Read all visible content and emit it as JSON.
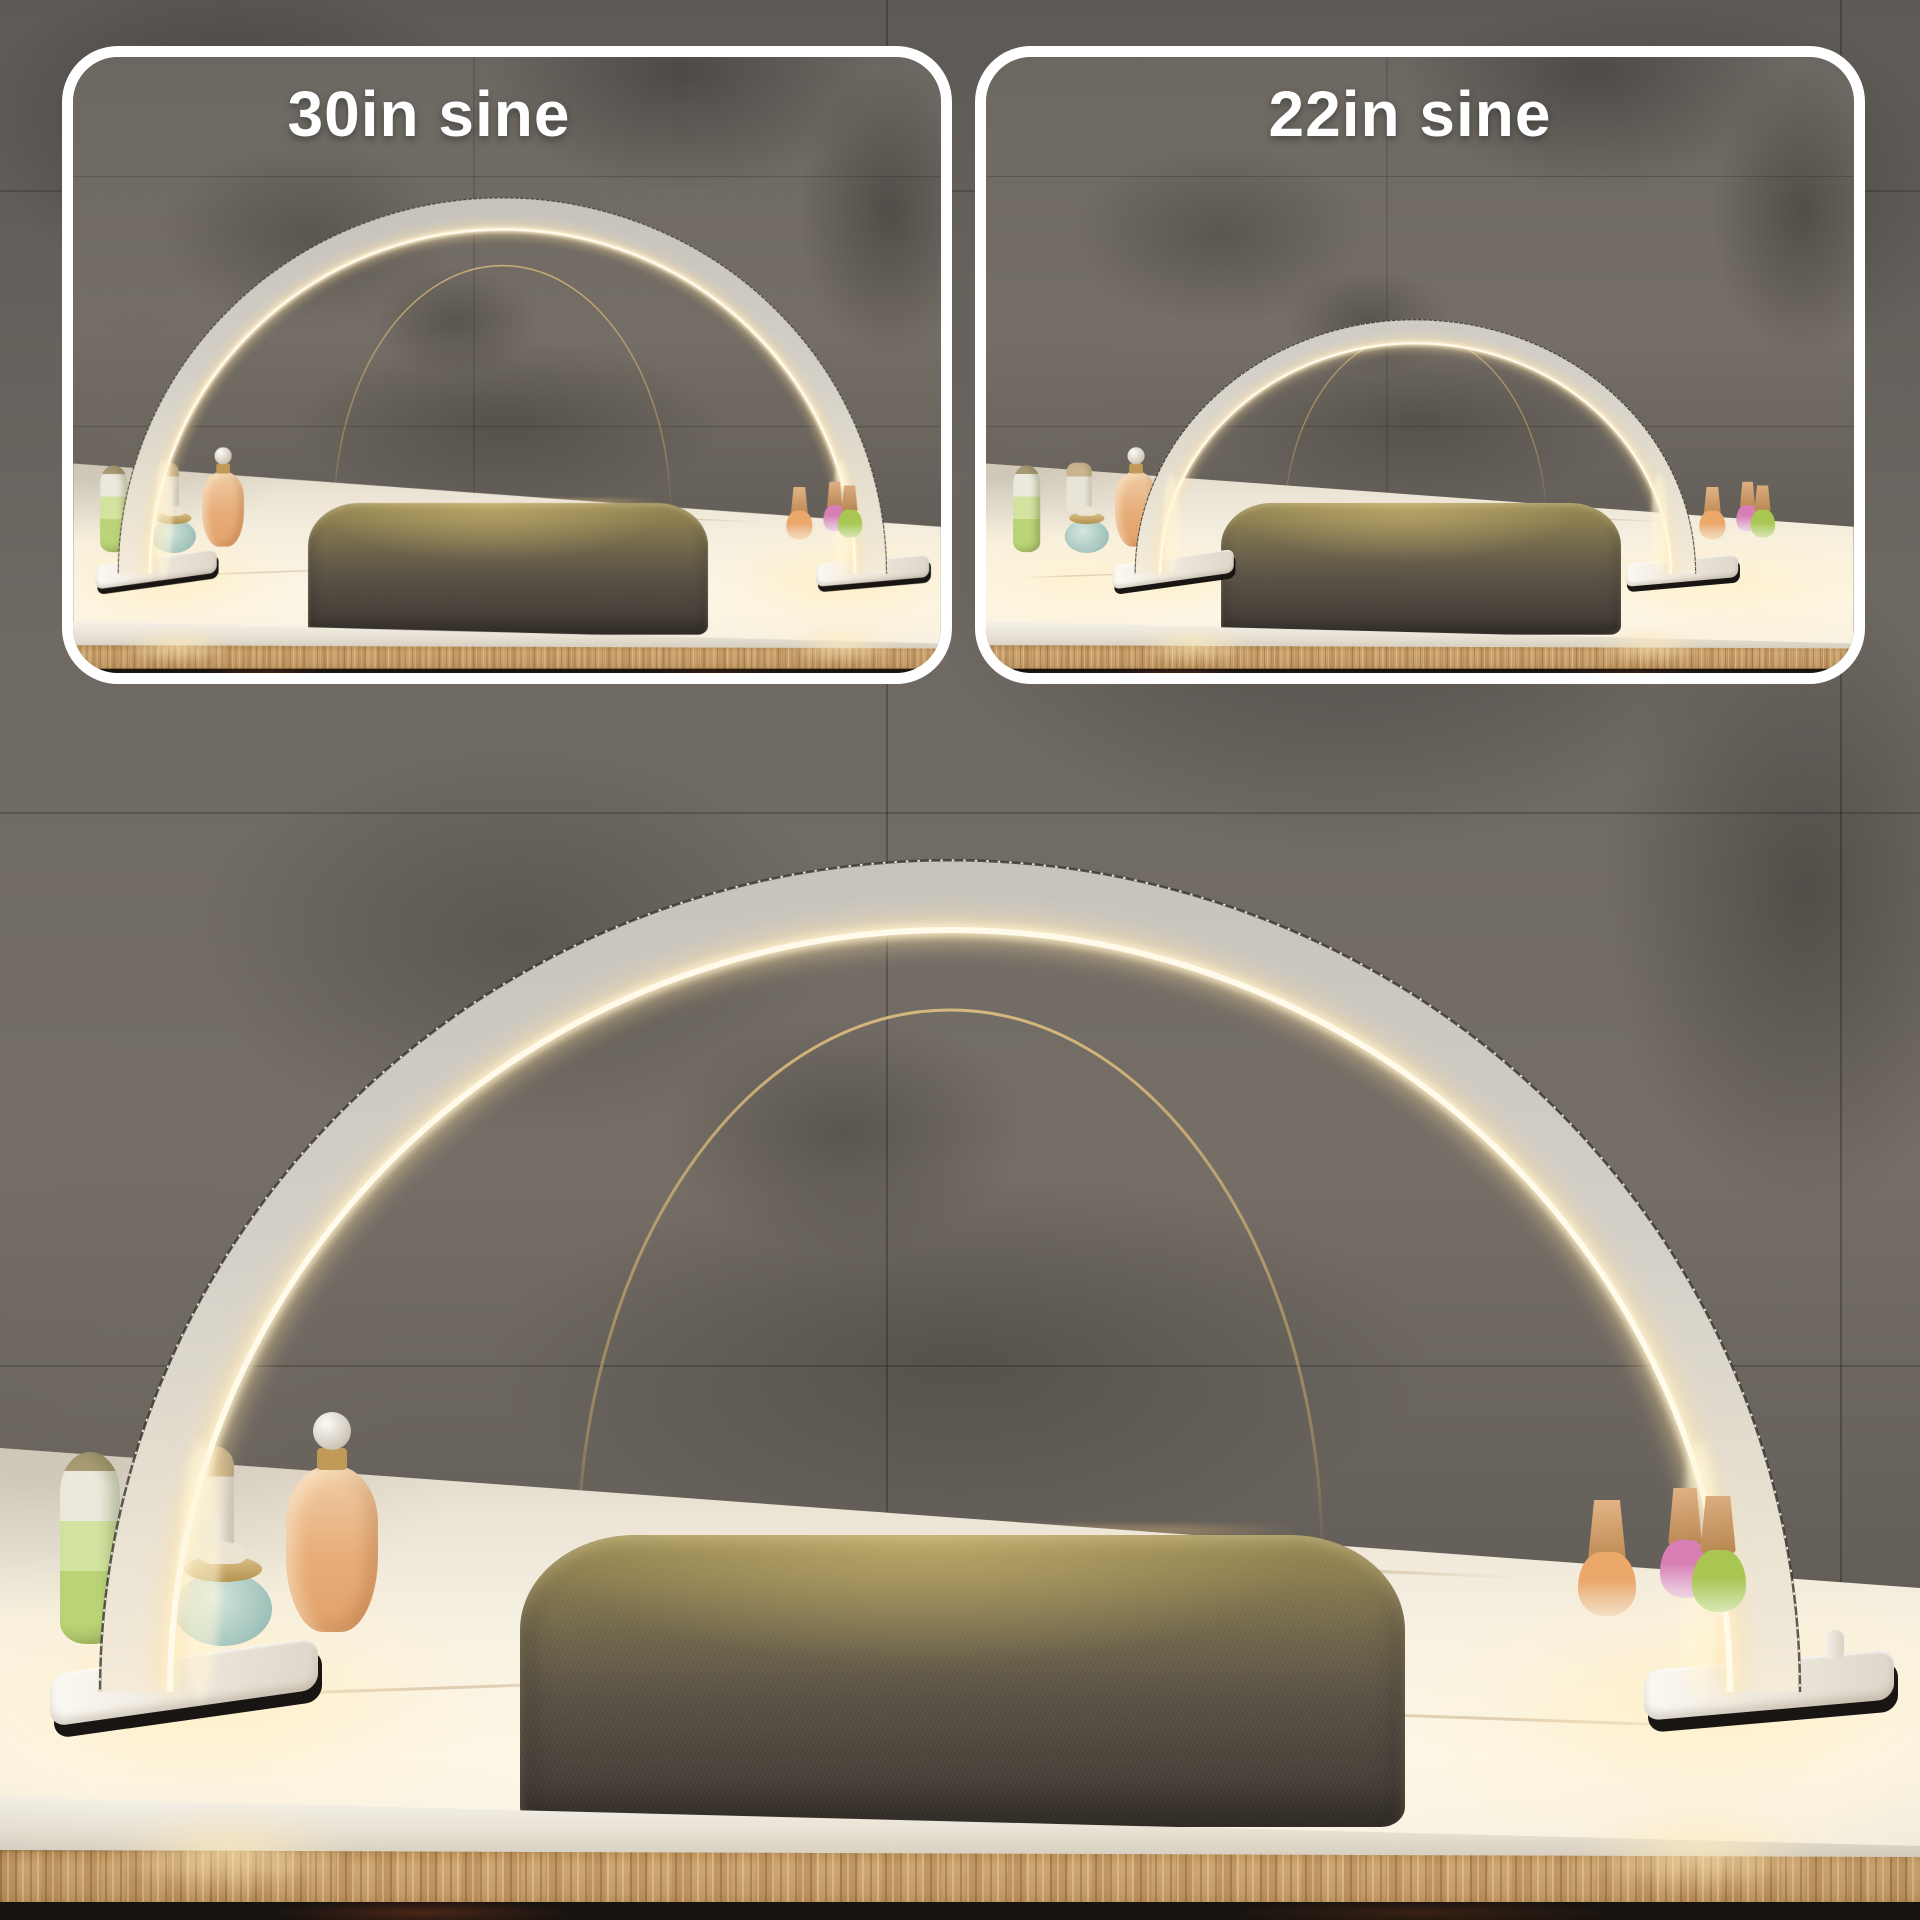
{
  "panels": [
    {
      "id": "30in",
      "label": "30in sine"
    },
    {
      "id": "22in",
      "label": "22in sine"
    }
  ],
  "colors": {
    "panel_border": "#ffffff",
    "label_text": "#ffffff",
    "wall_marble": "#6b6661",
    "countertop": "#f7f1e3",
    "wood_edge": "#c59d69",
    "lamp_body": "#cdc9c1",
    "lamp_led_glow": "#fff6dd",
    "reflection_gold": "#d0ad72",
    "cushion_lit": "#96874f",
    "cushion_dark": "#4a443b",
    "polish_orange": "#eca86b",
    "polish_pink": "#d77fb4",
    "polish_green": "#a9c653",
    "cap_rose_gold": "#d4a476"
  }
}
